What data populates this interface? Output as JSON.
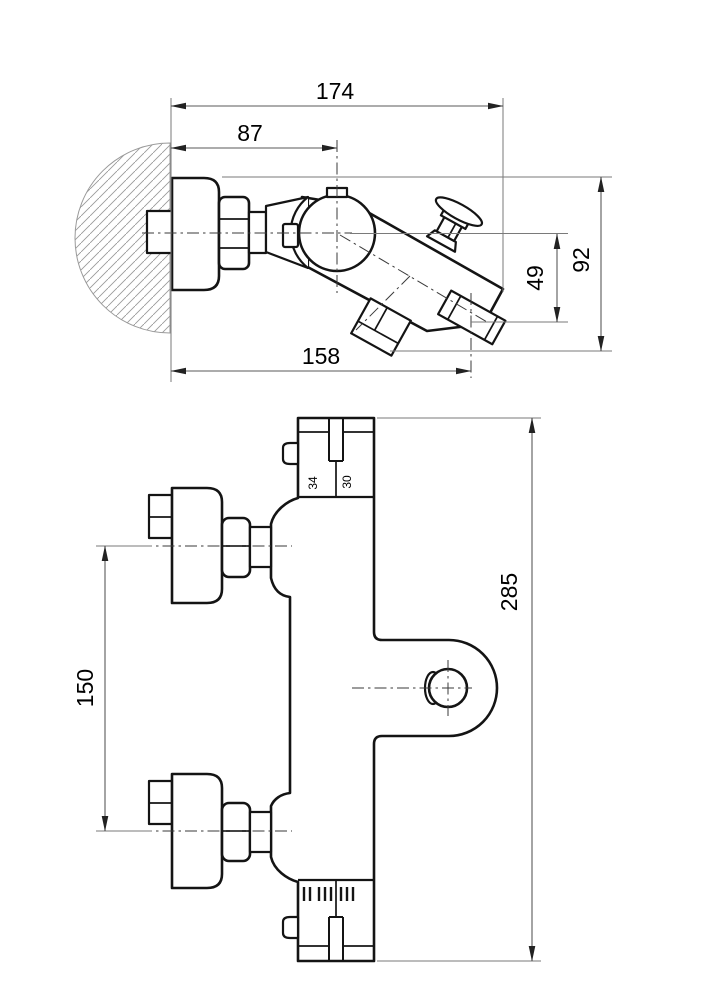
{
  "drawing": {
    "description": "Wall-mounted thermostatic bath mixer — two-view dimensional drawing",
    "side_view": {
      "dims": {
        "total_depth": "174",
        "wall_to_cartridge_axis": "87",
        "total_height": "92",
        "axis_to_spout": "49",
        "wall_to_outlet": "158"
      }
    },
    "front_view": {
      "dims": {
        "total_height": "285",
        "inlet_centres": "150"
      },
      "temp_scale_labels": [
        "34",
        "30"
      ]
    }
  }
}
